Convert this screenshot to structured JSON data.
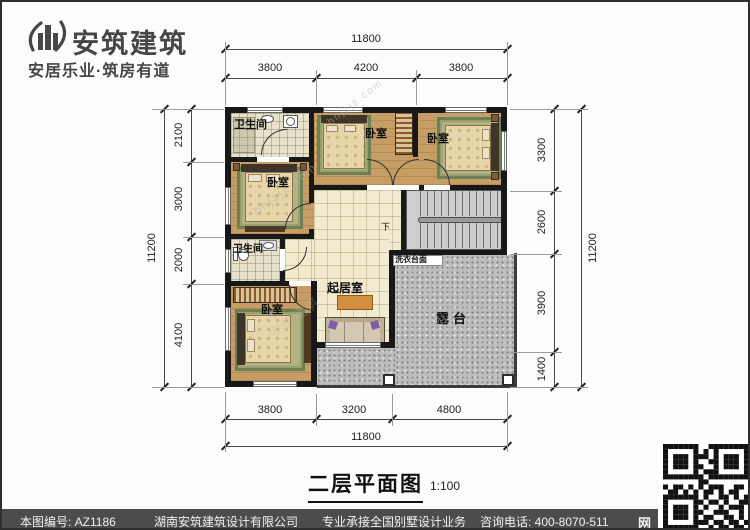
{
  "brand": {
    "name": "安筑建筑",
    "tagline": "安居乐业·筑房有道"
  },
  "plan": {
    "title": "二层平面图",
    "scale": "1:100",
    "watermark": "hnjzjz.com",
    "watermark_brand": "安筑建筑",
    "labels": {
      "bath_top": "卫生间",
      "bed_left": "卧室",
      "bed_top_mid": "卧室",
      "bed_top_right": "卧室",
      "bath_mid": "卫生间",
      "bed_bottom": "卧室",
      "living": "起居室",
      "laundry": "洗衣台面",
      "terrace": "露台",
      "stairs_down": "下"
    },
    "dims": {
      "top_total": "11800",
      "top_segments": [
        "3800",
        "4200",
        "3800"
      ],
      "bottom_total": "11800",
      "bottom_segments": [
        "3800",
        "3200",
        "4800"
      ],
      "left_total": "11200",
      "left_segments": [
        "2100",
        "3000",
        "2000",
        "4100"
      ],
      "right_total": "11200",
      "right_segments": [
        "3300",
        "2600",
        "3900",
        "1400"
      ]
    }
  },
  "footer": {
    "drawing_no": "本图编号: AZ1186",
    "company": "湖南安筑建筑设计有限公司",
    "service": "专业承接全国别墅设计业务",
    "phone": "咨询电话: 400-8070-511",
    "net": "网"
  },
  "qr": {
    "rows": [
      "11111110011111111",
      "10000010101000001",
      "10111011101011101",
      "10111010011011101",
      "10111011001011101",
      "10000010111000001",
      "11111111011111111",
      "00000001100000000",
      "10110101011100110",
      "01101010110101100",
      "11111110100110101",
      "10000011011010011",
      "10111010100101110",
      "10111011001110010",
      "10111010110011010",
      "10000011101101101",
      "11111110010110110"
    ]
  }
}
